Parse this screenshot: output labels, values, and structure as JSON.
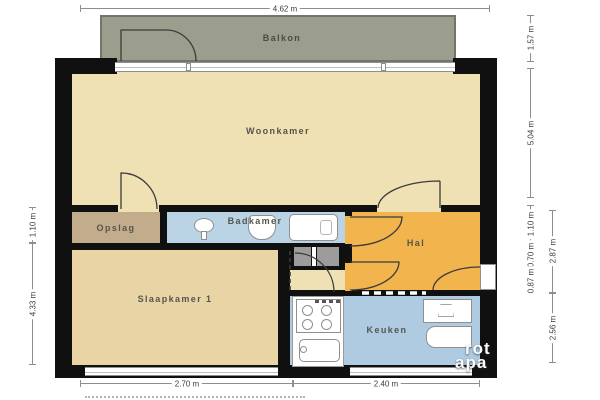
{
  "rooms": {
    "balkon": "Balkon",
    "woonkamer": "Woonkamer",
    "opslag": "Opslag",
    "badkamer": "Badkamer",
    "hal": "Hal",
    "slaapkamer": "Slaapkamer 1",
    "keuken": "Keuken"
  },
  "dimensions": {
    "top": "4.62 m",
    "bottom": {
      "left": "2.70 m",
      "right": "2.40 m"
    },
    "left": {
      "upper": "1.10 m",
      "lower": "4.33 m"
    },
    "right": {
      "balcony": "1.57 m",
      "woonkamer": "5.04 m",
      "badkamer": "1.10 m",
      "closet": "0.70 m",
      "entry": "0.87 m",
      "hal_total": "2.87 m",
      "keuken": "2.56 m"
    }
  },
  "watermark": {
    "line1": "rot",
    "line2": "apa"
  },
  "colors": {
    "wall": "#101010",
    "balkon": "#9b9e8c",
    "woonkamer": "#efe1b3",
    "slaapkamer": "#e8d4a4",
    "opslag": "#c3ac8b",
    "badkamer": "#bad3e5",
    "keuken": "#aecbe1",
    "hal": "#f2b54e",
    "closet": "#9c9c9c",
    "window_sliver": "#ffffff"
  }
}
